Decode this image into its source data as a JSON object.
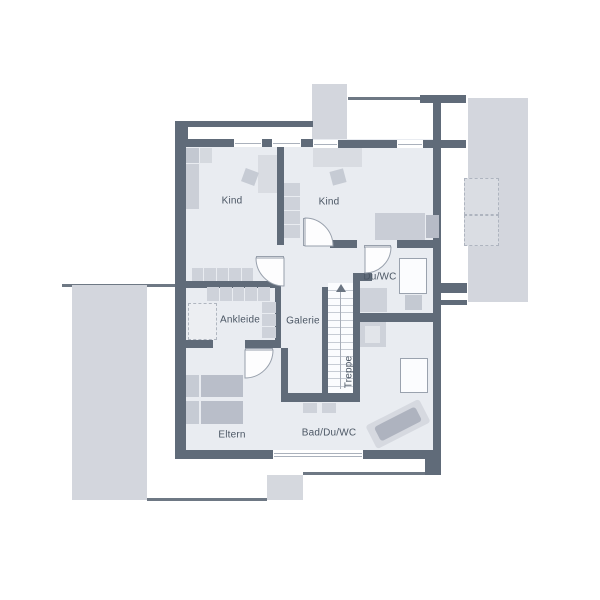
{
  "title": "floor-plan-upper-storey",
  "labels": {
    "kind1": "Kind",
    "kind2": "Kind",
    "duwc": "Du/WC",
    "ankleide": "Ankleide",
    "galerie": "Galerie",
    "treppe": "Treppe",
    "eltern": "Eltern",
    "bad": "Bad/Du/WC"
  },
  "palette": {
    "wall": "#606b79",
    "roofline": "#6e7884",
    "floor": "#e9ecf1",
    "outside": "#d3d6dd",
    "furniture": "#ced2da",
    "furniture_dark": "#b9bec9",
    "furniture_light": "#d9dce2",
    "stair_bg": "#fbfcfe",
    "stair_line": "#c7ccd4",
    "door_stroke": "#98a0ac",
    "text": "#4b5664"
  },
  "plan": {
    "elements": [
      {
        "name": "roof-line-left",
        "kind": "rect",
        "x": 62,
        "y": 284,
        "w": 118,
        "h": 3,
        "fill": "#6e7884"
      },
      {
        "name": "terrace-left",
        "kind": "rect",
        "x": 72,
        "y": 285,
        "w": 75,
        "h": 215,
        "fill": "#d3d6dd"
      },
      {
        "name": "roof-line-bottom-left",
        "kind": "rect",
        "x": 147,
        "y": 498,
        "w": 120,
        "h": 3,
        "fill": "#6e7884"
      },
      {
        "name": "terrace-bottom",
        "kind": "rect",
        "x": 267,
        "y": 475,
        "w": 36,
        "h": 25,
        "fill": "#d5d8de"
      },
      {
        "name": "roof-line-bottom-right",
        "kind": "rect",
        "x": 303,
        "y": 472,
        "w": 124,
        "h": 3,
        "fill": "#6e7884"
      },
      {
        "name": "roof-strip-top",
        "kind": "rect",
        "x": 312,
        "y": 84,
        "w": 35,
        "h": 57,
        "fill": "#d3d6dd"
      },
      {
        "name": "roof-line-top-right",
        "kind": "rect",
        "x": 348,
        "y": 97,
        "w": 118,
        "h": 3,
        "fill": "#6e7884"
      },
      {
        "name": "terrace-right",
        "kind": "rect",
        "x": 468,
        "y": 98,
        "w": 60,
        "h": 204,
        "fill": "#d3d6dd"
      },
      {
        "name": "dashed-box-upper",
        "kind": "rect",
        "x": 464,
        "y": 178,
        "w": 35,
        "h": 37,
        "fill": "#dadde3",
        "border": "1px dashed #aeb4bf"
      },
      {
        "name": "dashed-box-lower",
        "kind": "rect",
        "x": 464,
        "y": 215,
        "w": 35,
        "h": 31,
        "fill": "#dadde3",
        "border": "1px dashed #aeb4bf"
      },
      {
        "name": "floor",
        "kind": "rect",
        "x": 178,
        "y": 139,
        "w": 263,
        "h": 320,
        "fill": "#e9ecf1"
      },
      {
        "name": "wall-niche-top-left",
        "kind": "rect",
        "x": 188,
        "y": 127,
        "w": 124,
        "h": 12,
        "fill": "#ffffff"
      },
      {
        "name": "wall-corner-top-left",
        "kind": "rect",
        "x": 175,
        "y": 121,
        "w": 13,
        "h": 26,
        "fill": "#606b79"
      },
      {
        "name": "wall-outer-top",
        "kind": "rect",
        "x": 186,
        "y": 121,
        "w": 127,
        "h": 6,
        "fill": "#606b79"
      },
      {
        "name": "wall-top-left",
        "kind": "rect",
        "x": 186,
        "y": 139,
        "w": 127,
        "h": 8,
        "fill": "#606b79"
      },
      {
        "name": "wall-top-right",
        "kind": "rect",
        "x": 313,
        "y": 140,
        "w": 128,
        "h": 8,
        "fill": "#606b79"
      },
      {
        "name": "wall-stub-top-right",
        "kind": "rect",
        "x": 441,
        "y": 140,
        "w": 25,
        "h": 8,
        "fill": "#606b79"
      },
      {
        "name": "wall-block-top-right",
        "kind": "rect",
        "x": 420,
        "y": 95,
        "w": 46,
        "h": 8,
        "fill": "#606b79"
      },
      {
        "name": "wall-right-upper",
        "kind": "rect",
        "x": 433,
        "y": 103,
        "w": 8,
        "h": 38,
        "fill": "#606b79"
      },
      {
        "name": "wall-left",
        "kind": "rect",
        "x": 175,
        "y": 121,
        "w": 11,
        "h": 337,
        "fill": "#606b79"
      },
      {
        "name": "wall-right",
        "kind": "rect",
        "x": 433,
        "y": 141,
        "w": 8,
        "h": 319,
        "fill": "#606b79"
      },
      {
        "name": "wall-bottom",
        "kind": "rect",
        "x": 175,
        "y": 450,
        "w": 266,
        "h": 9,
        "fill": "#606b79"
      },
      {
        "name": "wall-stub-right-1",
        "kind": "rect",
        "x": 441,
        "y": 283,
        "w": 26,
        "h": 10,
        "fill": "#606b79"
      },
      {
        "name": "wall-stub-right-2",
        "kind": "rect",
        "x": 441,
        "y": 300,
        "w": 26,
        "h": 5,
        "fill": "#606b79"
      },
      {
        "name": "wall-block-bottom-right",
        "kind": "rect",
        "x": 425,
        "y": 459,
        "w": 16,
        "h": 16,
        "fill": "#606b79"
      },
      {
        "name": "wall-divider-kids",
        "kind": "rect",
        "x": 277,
        "y": 147,
        "w": 7,
        "h": 98,
        "fill": "#606b79"
      },
      {
        "name": "wall-kind1-ankleide",
        "kind": "rect",
        "x": 186,
        "y": 281,
        "w": 95,
        "h": 7,
        "fill": "#606b79"
      },
      {
        "name": "wall-ankleide-right",
        "kind": "rect",
        "x": 275,
        "y": 288,
        "w": 6,
        "h": 60,
        "fill": "#606b79"
      },
      {
        "name": "wall-ankleide-bottom-left",
        "kind": "rect",
        "x": 175,
        "y": 340,
        "w": 38,
        "h": 8,
        "fill": "#606b79"
      },
      {
        "name": "wall-ankleide-bottom-right",
        "kind": "rect",
        "x": 245,
        "y": 340,
        "w": 36,
        "h": 8,
        "fill": "#606b79"
      },
      {
        "name": "wall-eltern-right",
        "kind": "rect",
        "x": 281,
        "y": 348,
        "w": 7,
        "h": 49,
        "fill": "#606b79"
      },
      {
        "name": "wall-corridor-bottom",
        "kind": "rect",
        "x": 281,
        "y": 393,
        "w": 79,
        "h": 9,
        "fill": "#606b79"
      },
      {
        "name": "wall-stair-left",
        "kind": "rect",
        "x": 322,
        "y": 287,
        "w": 6,
        "h": 106,
        "fill": "#606b79"
      },
      {
        "name": "wall-stair-right",
        "kind": "rect",
        "x": 353,
        "y": 273,
        "w": 7,
        "h": 120,
        "fill": "#606b79"
      },
      {
        "name": "wall-stub-stair-top",
        "kind": "rect",
        "x": 353,
        "y": 273,
        "w": 19,
        "h": 8,
        "fill": "#606b79"
      },
      {
        "name": "wall-kind2-bottom-left",
        "kind": "rect",
        "x": 330,
        "y": 240,
        "w": 27,
        "h": 8,
        "fill": "#606b79"
      },
      {
        "name": "wall-kind2-bottom-right",
        "kind": "rect",
        "x": 397,
        "y": 240,
        "w": 44,
        "h": 8,
        "fill": "#606b79"
      },
      {
        "name": "wall-duwc-bottom",
        "kind": "rect",
        "x": 360,
        "y": 313,
        "w": 81,
        "h": 9,
        "fill": "#606b79"
      },
      {
        "name": "window-top-1",
        "kind": "window",
        "x": 234,
        "y": 139,
        "w": 28,
        "h": 8,
        "lines": 1
      },
      {
        "name": "window-top-2",
        "kind": "window",
        "x": 272,
        "y": 139,
        "w": 29,
        "h": 8,
        "lines": 1
      },
      {
        "name": "window-top-3",
        "kind": "window",
        "x": 313,
        "y": 140,
        "w": 25,
        "h": 8,
        "lines": 1
      },
      {
        "name": "window-top-4",
        "kind": "window",
        "x": 397,
        "y": 140,
        "w": 26,
        "h": 8,
        "lines": 1
      },
      {
        "name": "window-bottom",
        "kind": "window",
        "x": 273,
        "y": 450,
        "w": 90,
        "h": 9,
        "lines": 2
      },
      {
        "name": "staircase",
        "kind": "stairs",
        "x": 328,
        "y": 283,
        "w": 25,
        "h": 110,
        "steps": 14
      },
      {
        "name": "door-leaf-kind1",
        "kind": "rect",
        "x": 256,
        "y": 256,
        "w": 28,
        "h": 3,
        "fill": "#fdfdfe",
        "border": "1px solid #98a0ac"
      },
      {
        "name": "door-leaf-kind2",
        "kind": "rect",
        "x": 303,
        "y": 218,
        "w": 3,
        "h": 28,
        "fill": "#fdfdfe",
        "border": "1px solid #98a0ac"
      },
      {
        "name": "door-leaf-duwc",
        "kind": "rect",
        "x": 364,
        "y": 245,
        "w": 27,
        "h": 3,
        "fill": "#fdfdfe",
        "border": "1px solid #98a0ac"
      },
      {
        "name": "door-leaf-eltern",
        "kind": "rect",
        "x": 245,
        "y": 348,
        "w": 28,
        "h": 3,
        "fill": "#fdfdfe",
        "border": "1px solid #98a0ac"
      },
      {
        "name": "door-arc-kind1",
        "kind": "arc",
        "path": "M 284 258 L 256 258 A 28 28 0 0 0 284 286 Z"
      },
      {
        "name": "door-arc-kind2",
        "kind": "arc",
        "path": "M 305 246 L 305 218 A 28 28 0 0 1 333 246 Z"
      },
      {
        "name": "door-arc-duwc",
        "kind": "arc",
        "path": "M 365 247 L 391 247 A 26 26 0 0 1 365 273 Z"
      },
      {
        "name": "door-arc-eltern",
        "kind": "arc",
        "path": "M 245 350 L 273 350 A 28 28 0 0 1 245 378 Z"
      },
      {
        "name": "kind1-wardrobe-top-a",
        "kind": "rect",
        "x": 186,
        "y": 148,
        "w": 13,
        "h": 15,
        "fill": "#c3c8d1"
      },
      {
        "name": "kind1-wardrobe-top-b",
        "kind": "rect",
        "x": 200,
        "y": 148,
        "w": 12,
        "h": 15,
        "fill": "#d5d9df"
      },
      {
        "name": "kind1-wardrobe-tall",
        "kind": "rect",
        "x": 186,
        "y": 164,
        "w": 13,
        "h": 45,
        "fill": "#cbcfd7"
      },
      {
        "name": "kind1-desk",
        "kind": "rect",
        "x": 258,
        "y": 155,
        "w": 19,
        "h": 38,
        "fill": "#d9dce2"
      },
      {
        "name": "kind1-chair",
        "kind": "rect",
        "x": 243,
        "y": 170,
        "w": 14,
        "h": 14,
        "fill": "#c6cbd4",
        "rot": 20
      },
      {
        "name": "kind1-closet-row",
        "kind": "cells",
        "x": 192,
        "y": 268,
        "w": 61,
        "h": 13,
        "n": 5,
        "dir": "h",
        "fill": "#ced2da"
      },
      {
        "name": "kind2-desk",
        "kind": "rect",
        "x": 313,
        "y": 148,
        "w": 49,
        "h": 19,
        "fill": "#d9dce2"
      },
      {
        "name": "kind2-chair",
        "kind": "rect",
        "x": 331,
        "y": 170,
        "w": 14,
        "h": 14,
        "fill": "#c6cbd4",
        "rot": -15
      },
      {
        "name": "kind2-wardrobe",
        "kind": "cells",
        "x": 284,
        "y": 183,
        "w": 16,
        "h": 55,
        "n": 4,
        "dir": "v",
        "fill": "#ced2da"
      },
      {
        "name": "kind2-bed",
        "kind": "rect",
        "x": 375,
        "y": 213,
        "w": 50,
        "h": 27,
        "fill": "#c9cdd6"
      },
      {
        "name": "kind2-bed-pillow",
        "kind": "rect",
        "x": 426,
        "y": 215,
        "w": 13,
        "h": 23,
        "fill": "#b6bbc6"
      },
      {
        "name": "duwc-shower",
        "kind": "rect",
        "x": 399,
        "y": 258,
        "w": 28,
        "h": 36,
        "fill": "#fbfcfe",
        "border": "1px solid #9aa2ae"
      },
      {
        "name": "duwc-washbasin",
        "kind": "rect",
        "x": 360,
        "y": 288,
        "w": 27,
        "h": 24,
        "fill": "#ced2da"
      },
      {
        "name": "duwc-wc",
        "kind": "rect",
        "x": 405,
        "y": 295,
        "w": 17,
        "h": 15,
        "fill": "#c4c9d2"
      },
      {
        "name": "ankleide-closet-row",
        "kind": "cells",
        "x": 207,
        "y": 287,
        "w": 63,
        "h": 14,
        "n": 5,
        "dir": "h",
        "fill": "#ced2da"
      },
      {
        "name": "ankleide-closet-col",
        "kind": "cells",
        "x": 262,
        "y": 302,
        "w": 14,
        "h": 36,
        "n": 3,
        "dir": "v",
        "fill": "#ced2da"
      },
      {
        "name": "ankleide-dashed-box",
        "kind": "rect",
        "x": 188,
        "y": 303,
        "w": 29,
        "h": 37,
        "fill": "#eceef2",
        "border": "1px dashed #b0b6c0"
      },
      {
        "name": "eltern-bed-pillow-1",
        "kind": "rect",
        "x": 186,
        "y": 375,
        "w": 13,
        "h": 22,
        "fill": "#c6cbd4"
      },
      {
        "name": "eltern-bed-pillow-2",
        "kind": "rect",
        "x": 186,
        "y": 401,
        "w": 13,
        "h": 23,
        "fill": "#c6cbd4"
      },
      {
        "name": "eltern-bed-mattress-1",
        "kind": "rect",
        "x": 201,
        "y": 375,
        "w": 42,
        "h": 22,
        "fill": "#b9bec9"
      },
      {
        "name": "eltern-bed-mattress-2",
        "kind": "rect",
        "x": 201,
        "y": 401,
        "w": 42,
        "h": 23,
        "fill": "#b9bec9"
      },
      {
        "name": "bad-washbasin-1",
        "kind": "rect",
        "x": 303,
        "y": 403,
        "w": 14,
        "h": 10,
        "fill": "#ced2da"
      },
      {
        "name": "bad-washbasin-2",
        "kind": "rect",
        "x": 322,
        "y": 403,
        "w": 14,
        "h": 10,
        "fill": "#ced2da"
      },
      {
        "name": "bad-wc-unit",
        "kind": "rect",
        "x": 360,
        "y": 322,
        "w": 26,
        "h": 25,
        "fill": "#ced2da"
      },
      {
        "name": "bad-wc-unit-inner",
        "kind": "rect",
        "x": 365,
        "y": 326,
        "w": 15,
        "h": 17,
        "fill": "#e2e5ea"
      },
      {
        "name": "bad-shower",
        "kind": "rect",
        "x": 400,
        "y": 358,
        "w": 28,
        "h": 35,
        "fill": "#fbfcfe",
        "border": "1px solid #9aa2ae"
      },
      {
        "name": "bathtub-outer",
        "kind": "rect",
        "x": 368,
        "y": 411,
        "w": 60,
        "h": 26,
        "fill": "#d6d9e0",
        "rot": -27,
        "radius": 3
      },
      {
        "name": "bathtub-inner",
        "kind": "rect",
        "x": 375,
        "y": 416,
        "w": 46,
        "h": 16,
        "fill": "#aeb3bf",
        "rot": -27,
        "radius": 3
      },
      {
        "name": "room-label-kind1",
        "kind": "text",
        "bind": "kind1",
        "x": 232,
        "y": 201
      },
      {
        "name": "room-label-kind2",
        "kind": "text",
        "bind": "kind2",
        "x": 329,
        "y": 202
      },
      {
        "name": "room-label-duwc",
        "kind": "text",
        "bind": "duwc",
        "x": 380,
        "y": 277
      },
      {
        "name": "room-label-ankleide",
        "kind": "text",
        "bind": "ankleide",
        "x": 240,
        "y": 320
      },
      {
        "name": "room-label-galerie",
        "kind": "text",
        "bind": "galerie",
        "x": 303,
        "y": 321
      },
      {
        "name": "room-label-treppe",
        "kind": "text",
        "bind": "treppe",
        "x": 349,
        "y": 372,
        "rot": -90
      },
      {
        "name": "room-label-eltern",
        "kind": "text",
        "bind": "eltern",
        "x": 232,
        "y": 435
      },
      {
        "name": "room-label-bad",
        "kind": "text",
        "bind": "bad",
        "x": 329,
        "y": 433
      }
    ]
  }
}
